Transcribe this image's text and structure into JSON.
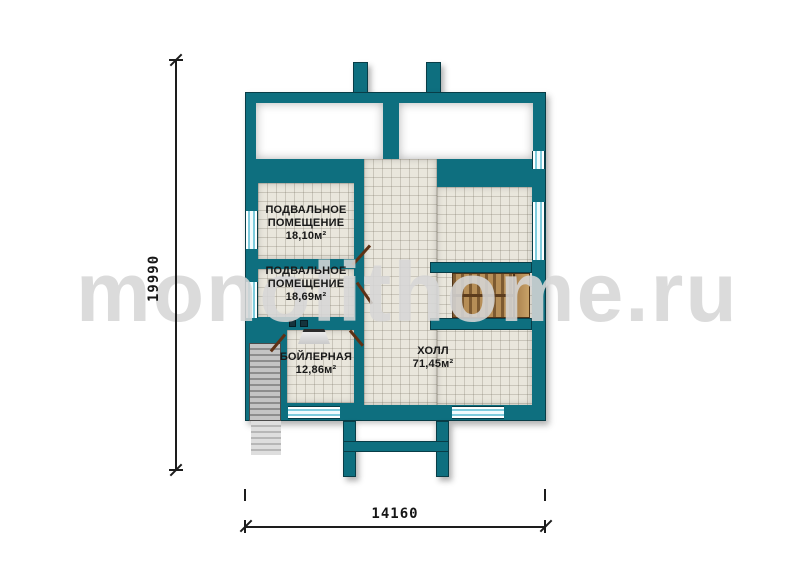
{
  "watermark": {
    "text": "monolithome.ru"
  },
  "dimensions": {
    "height_mm": "19990",
    "width_mm": "14160"
  },
  "rooms": {
    "basement1": {
      "line1": "ПОДВАЛЬНОЕ",
      "line2": "ПОМЕЩЕНИЕ",
      "area": "18,10м²"
    },
    "basement2": {
      "line1": "ПОДВАЛЬНОЕ",
      "line2": "ПОМЕЩЕНИЕ",
      "area": "18,69м²"
    },
    "boiler": {
      "name": "БОЙЛЕРНАЯ",
      "area": "12,86м²"
    },
    "hall": {
      "name": "ХОЛЛ",
      "area": "71,45м²"
    }
  },
  "colors": {
    "wall_teal": "#0e6f7f",
    "wall_outline": "#083d47",
    "floor_tile": "#e9e6dc",
    "wood": "#b68e57",
    "window_glass": "#7fccdd",
    "door": "#5e3115",
    "watermark_gray": "#d6d6d6"
  }
}
